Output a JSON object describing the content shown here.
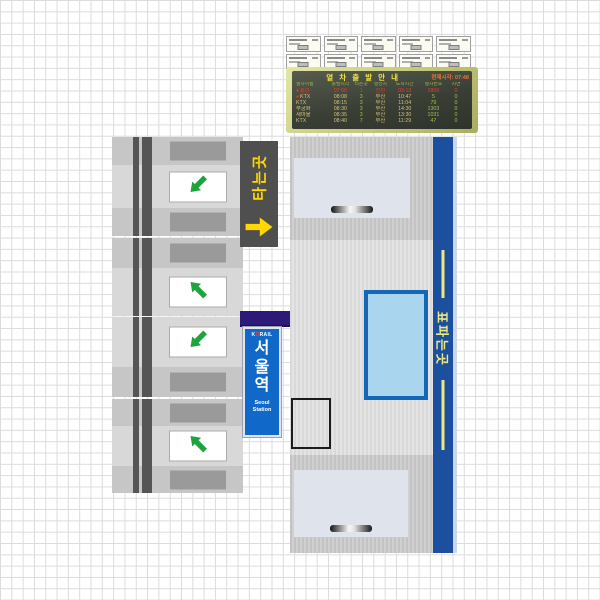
{
  "departure_board": {
    "title": "열 차 출 발 안 내",
    "clock_label": "현재시각: 07:48",
    "columns": [
      "열차이름",
      "출발시각",
      "타는곳",
      "행선지",
      "도착시간",
      "열차번호",
      "지연"
    ],
    "rows": [
      {
        "dot": true,
        "alert": true,
        "name": "통근",
        "depart": "07:50",
        "platform": "1",
        "dest": "천안",
        "arrive": "09:13",
        "train_no": "2800",
        "delay": "0"
      },
      {
        "dot": true,
        "alert": false,
        "name": "KTX",
        "depart": "08:08",
        "platform": "3",
        "dest": "부산",
        "arrive": "10:47",
        "train_no": "5",
        "delay": "0"
      },
      {
        "dot": false,
        "alert": false,
        "name": "KTX",
        "depart": "08:15",
        "platform": "3",
        "dest": "부산",
        "arrive": "11:04",
        "train_no": "79",
        "delay": "0"
      },
      {
        "dot": false,
        "alert": false,
        "name": "무궁화",
        "depart": "08:30",
        "platform": "3",
        "dest": "부산",
        "arrive": "14:30",
        "train_no": "1303",
        "delay": "0"
      },
      {
        "dot": false,
        "alert": false,
        "name": "새마을",
        "depart": "08:35",
        "platform": "3",
        "dest": "부산",
        "arrive": "13:30",
        "train_no": "1031",
        "delay": "0"
      },
      {
        "dot": false,
        "alert": false,
        "name": "KTX",
        "depart": "08:40",
        "platform": "7",
        "dest": "부산",
        "arrive": "11:29",
        "train_no": "47",
        "delay": "0"
      }
    ],
    "colors": {
      "frame": "#c9cd7e",
      "panel": "#3a3f36",
      "title": "#f2e23c",
      "clock": "#e8742f",
      "header": "#9fb054",
      "text": "#d2c178",
      "accent": "#9cc04a",
      "alert": "#e8392f"
    }
  },
  "ticket_wall": {
    "rows": 2,
    "cols": 5
  },
  "gates": {
    "arrow_color": "#1fa33c",
    "units": [
      {
        "bands": [
          "slot",
          "arrow-dl",
          "slot"
        ]
      },
      {
        "bands": [
          "slot",
          "arrow-ul"
        ]
      },
      {
        "bands": [
          "arrow-dl",
          "slot"
        ]
      },
      {
        "bands": [
          "slot",
          "arrow-ul",
          "slot"
        ]
      }
    ]
  },
  "boarding_sign": {
    "label": "타는곳",
    "arrow_direction": "right",
    "bg": "#4f4f4f",
    "fg": "#ffd800"
  },
  "station_sign": {
    "brand_k": "K",
    "brand_o": "O",
    "brand_rail": "RAIL",
    "name": "서울역",
    "name_en": "Seoul Station",
    "bg": "#1069c8",
    "awning": "#2d1a78",
    "brand_o_color": "#ff3b30"
  },
  "ticket_hall": {
    "banner_label": "표파는곳",
    "banner_bg": "#1d4f9f",
    "banner_fg": "#efe87e"
  }
}
